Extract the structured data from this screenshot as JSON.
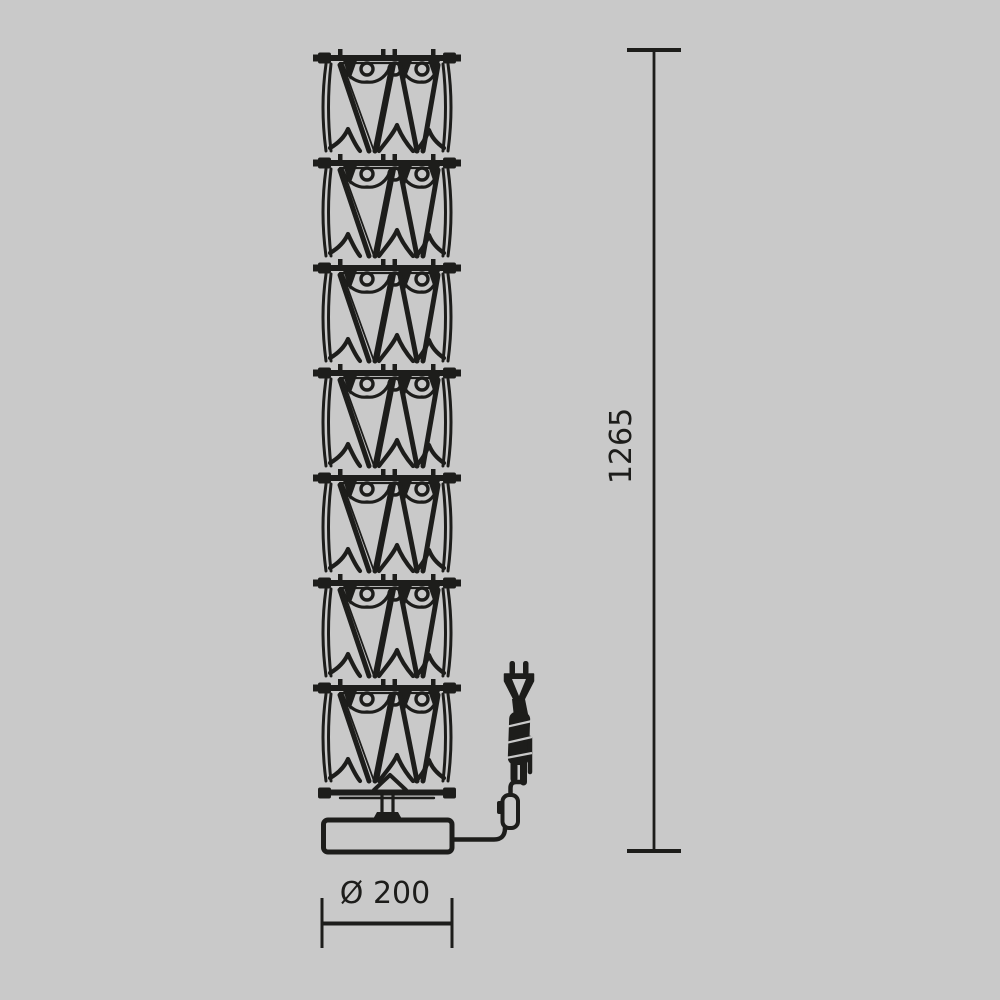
{
  "drawing": {
    "title": "Floor lamp technical dimension drawing",
    "object": "crystal-module floor lamp with base, power cord and plug",
    "module_count": 7,
    "colors": {
      "background": "#c9c9c9",
      "line": "#1d1d1b"
    },
    "dimensions": {
      "height": {
        "value": "1265",
        "orientation": "vertical",
        "side": "right"
      },
      "base_diameter": {
        "value": "Ø 200",
        "orientation": "horizontal",
        "side": "bottom"
      }
    }
  }
}
